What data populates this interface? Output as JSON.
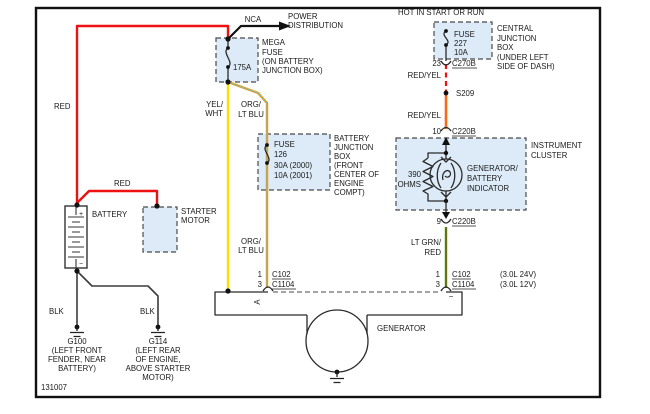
{
  "colors": {
    "box_fill": "#dcebf7",
    "wire_red": "#ee1111",
    "wire_yellow": "#ffdf00",
    "wire_orange": "#ff9100",
    "stripe_ltblu": "#63c8c8",
    "stripe_yellow": "#ffe000",
    "wire_green": "#0fb70f",
    "stripe_red": "#ee1111",
    "wire_black": "#3c3c3c"
  },
  "diagram": {
    "id": "131007",
    "header": "HOT IN START OR RUN",
    "power": {
      "nca": "NCA",
      "dest": [
        "POWER",
        "DISTRIBUTION"
      ]
    },
    "mega_fuse": {
      "rating": "175A",
      "label": [
        "MEGA",
        "FUSE",
        "(ON BATTERY",
        "JUNCTION BOX)"
      ]
    },
    "cjb": {
      "fuse_lines": [
        "FUSE",
        "227",
        "10A"
      ],
      "label": [
        "CENTRAL",
        "JUNCTION",
        "BOX",
        "(UNDER LEFT",
        "SIDE OF DASH)"
      ]
    },
    "bjb": {
      "fuse_lines": [
        "FUSE",
        "126",
        "30A (2000)",
        "10A (2001)"
      ],
      "label": [
        "BATTERY",
        "JUNCTION",
        "BOX",
        "(FRONT",
        "CENTER OF",
        "ENGINE",
        "COMPT)"
      ]
    },
    "battery": {
      "label": "BATTERY",
      "plus": "+",
      "minus": "−"
    },
    "starter": {
      "label": [
        "STARTER",
        "MOTOR"
      ]
    },
    "cluster": {
      "label": [
        "INSTRUMENT",
        "CLUSTER"
      ],
      "resistor": [
        "390",
        "OHMS"
      ],
      "indicator": [
        "GENERATOR/",
        "BATTERY",
        "INDICATOR"
      ]
    },
    "generator": {
      "label": "GENERATOR",
      "term_a": "A",
      "term_minus": "−"
    },
    "splice": "S209",
    "wire_labels": {
      "red_main": "RED",
      "red_branch": "RED",
      "yelwht": [
        "YEL/",
        "WHT"
      ],
      "orgltblu_1": [
        "ORG/",
        "LT BLU"
      ],
      "orgltblu_2": [
        "ORG/",
        "LT BLU"
      ],
      "redyel_1": "RED/YEL",
      "redyel_2": "RED/YEL",
      "ltgrnred": [
        "LT GRN/",
        "RED"
      ],
      "blk_1": "BLK",
      "blk_2": "BLK"
    },
    "conn": {
      "c270b": {
        "pin": "23",
        "name": "C270B"
      },
      "c220b_top": {
        "pin": "10",
        "name": "C220B"
      },
      "c220b_bot": {
        "pin": "9",
        "name": "C220B"
      },
      "gen_left": {
        "pin1": "1",
        "name1": "C102",
        "pin3": "3",
        "name3": "C1104"
      },
      "gen_right": {
        "pin1": "1",
        "name1": "C102",
        "pin3": "3",
        "name3": "C1104"
      }
    },
    "engine_notes": [
      "(3.0L 24V)",
      "(3.0L 12V)"
    ],
    "grounds": {
      "g100": [
        "G100",
        "(LEFT FRONT",
        "FENDER, NEAR",
        "BATTERY)"
      ],
      "g114": [
        "G114",
        "(LEFT REAR",
        "OF ENGINE,",
        "ABOVE STARTER",
        "MOTOR)"
      ]
    }
  }
}
